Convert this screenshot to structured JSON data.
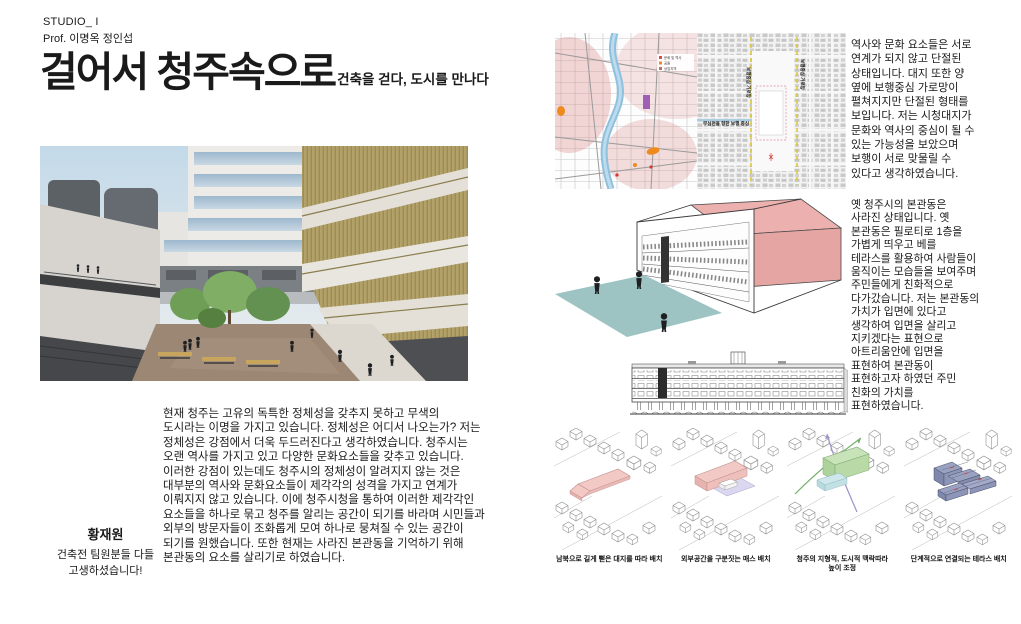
{
  "header": {
    "studio": "STUDIO_ I",
    "professor": "Prof. 이명옥 정인섭",
    "title": "걸어서 청주속으로",
    "subtitle": "건축을 걷다, 도시를 만나다"
  },
  "intro": {
    "body": "현재 청주는  고유의 독특한 정체성을 갖추지 못하고 무색의\n도시라는 이명을 가지고 있습니다. 정체성은 어디서 나오는가? 저는\n정체성은 강점에서 더욱 두드러진다고 생각하였습니다. 청주시는\n오랜 역사를 가지고 있고 다양한 문화요소들을 갖추고 있습니다.\n이러한 강점이 있는데도 청주시의 정체성이 알려지지 않는 것은\n대부분의 역사와 문화요소들이 제각각의 성격을 가지고 연계가\n이뤄지지 않고 있습니다. 이에 청주시청을 통하여 이러한 제각각인\n요소들을 하나로 묶고 청주를 알리는 공간이 되기를 바라며 시민들과\n외부의 방문자들이 조화롭게 모여 하나로 뭉쳐질 수 있는 공간이\n되기를 원했습니다. 또한 현재는 사라진 본관동을 기억하기 위해\n본관동의 요소를 살리기로 하였습니다."
  },
  "author": {
    "name": "황재원",
    "note": "건축전 팀원분들 다들\n고생하셨습니다!"
  },
  "analysis": {
    "site_text": "역사와 문화 요소들은 서로\n연계가 되지 않고 단절된\n상태입니다. 대지 또한 양\n옆에 보행중심 가로망이\n펼쳐지지만 단절된 형태를\n보입니다. 저는 시청대지가\n문화와 역사의 중심이 될 수\n있는 가능성을 보았으며\n보행이 서로 맞물릴 수\n있다고 생각하였습니다.",
    "bonkwan_text": "옛 청주시의 본관동은\n사라진 상태입니다. 옛\n본관동은 필로티로 1층을\n가볍게 띄우고 베를\n테라스를 활용하여 사람들이\n움직이는 모습들을 보여주며\n주민들에게 친화적으로\n다가갔습니다. 저는 본관동의\n가치가 입면에 있다고\n생각하여 입면을 살리고\n지키겠다는 표현으로\n아트리움안에 입면을\n표현하여 본관동이\n표현하고자 하였던 주민\n친화의 가치를\n표현하였습니다."
  },
  "maps": {
    "legend": [
      "문화 및 역사",
      "공원",
      "상업지역"
    ],
    "corridor_label_left": "보행중심 가로망",
    "corridor_label_right": "보행중심 가로망",
    "pedestrian_label": "무심천을 향한 보행 중심"
  },
  "diagrams": {
    "captions": [
      "남북으로 길게 뻗은 대지를 따라 배치",
      "외부공간을 구분짓는 매스 배치",
      "청주의 지형적, 도시적 맥락따라\n높이 조정",
      "단계적으로 연결되는 테라스 배치"
    ]
  },
  "colors": {
    "accent_pink": "#ecb0ae",
    "accent_teal": "#9dc3c2",
    "accent_green": "#c2e0b2",
    "accent_navy": "#8d95b8",
    "map_orange": "#ef8b1d",
    "map_purple": "#a05fb5",
    "map_river": "#8fc0dd",
    "map_yellow": "#ddc93f"
  }
}
